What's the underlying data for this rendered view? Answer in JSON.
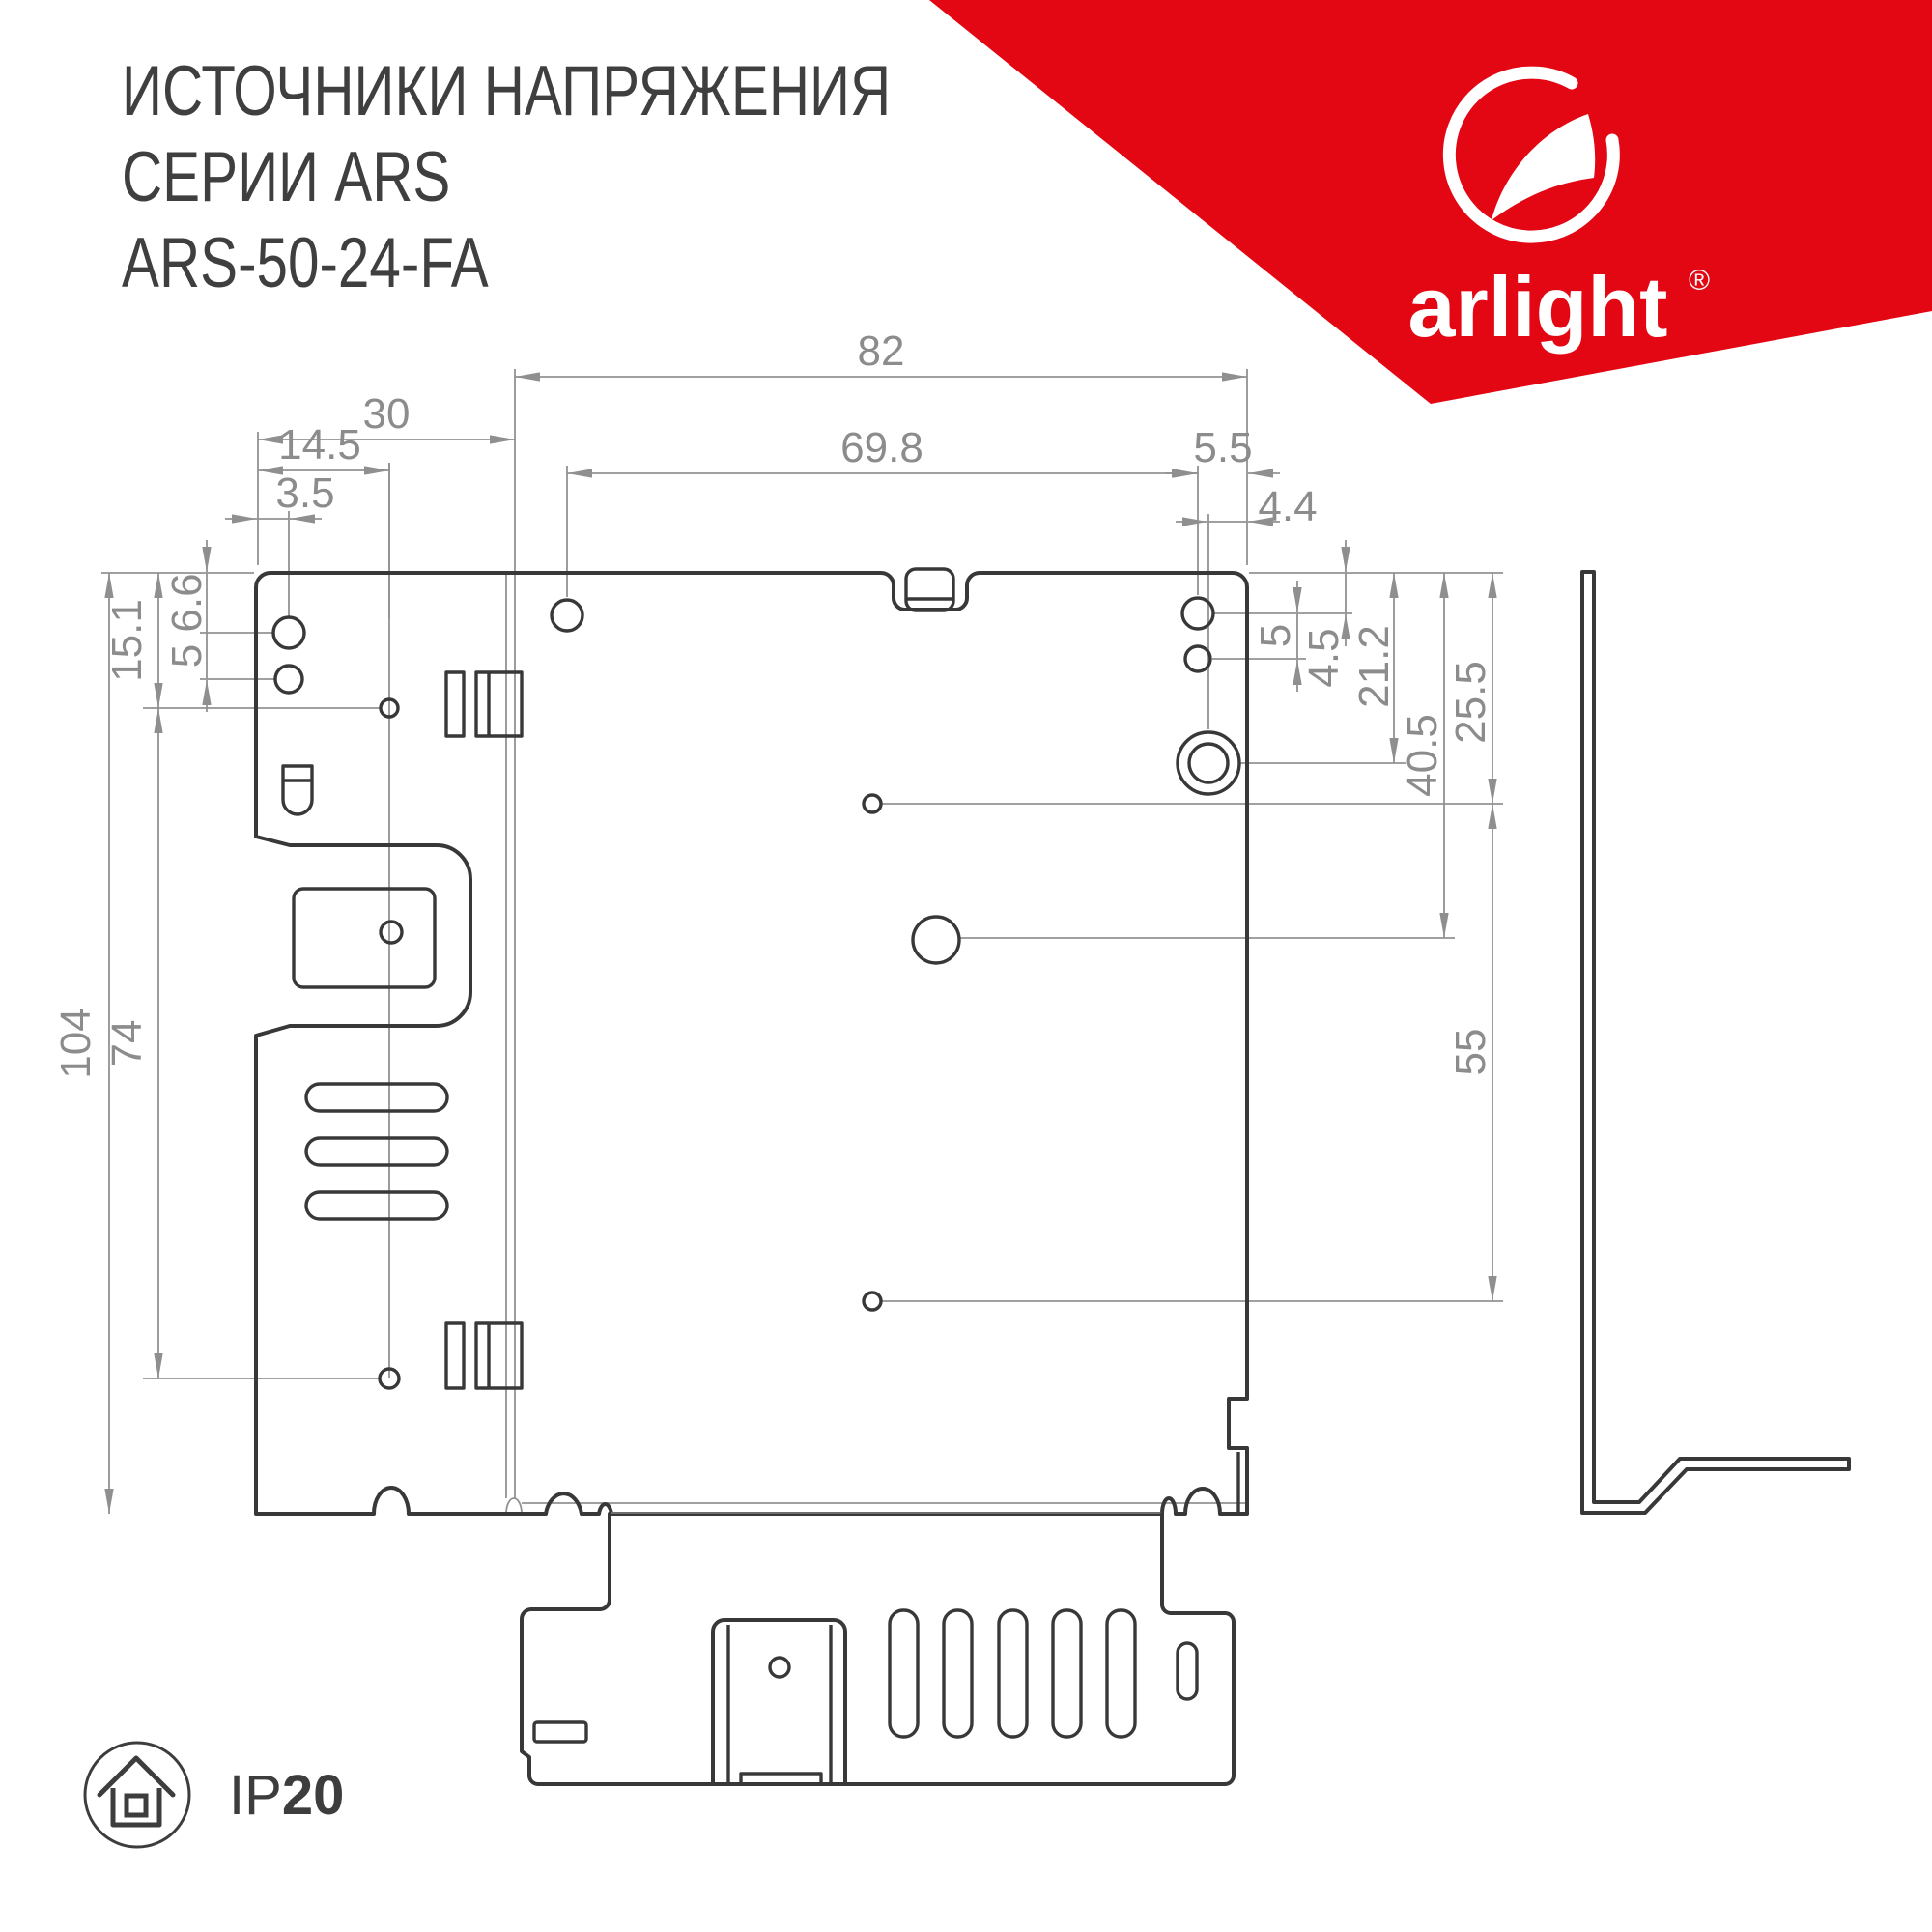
{
  "header": {
    "title_line1": "ИСТОЧНИКИ НАПРЯЖЕНИЯ",
    "title_line2": "СЕРИИ ARS",
    "title_line3": "ARS-50-24-FA"
  },
  "brand": {
    "logo_text": "arlight",
    "registered_mark": "®",
    "accent_color": "#e30613"
  },
  "footer": {
    "ip_prefix": "IP",
    "ip_value": "20"
  },
  "drawing": {
    "units": "mm",
    "dims": {
      "overall_width": "82",
      "flange_width": "30",
      "flange_hole_x": "14.5",
      "corner_hole_inset": "3.5",
      "top_hole_span": "69.8",
      "right_hole_inset": "5.5",
      "boss_inset": "4.4",
      "top_hole_down": "6.6",
      "left_hole_pitch": "5",
      "overall_height": "104",
      "flange_hole_span": "74",
      "flange_hole_top": "15.1",
      "right_top_offset": "4.5",
      "right_hole_pitch": "5",
      "boss_down": "21.2",
      "mid_hole_down": "25.5",
      "big_hole_down": "40.5",
      "low_hole_span": "55"
    }
  }
}
